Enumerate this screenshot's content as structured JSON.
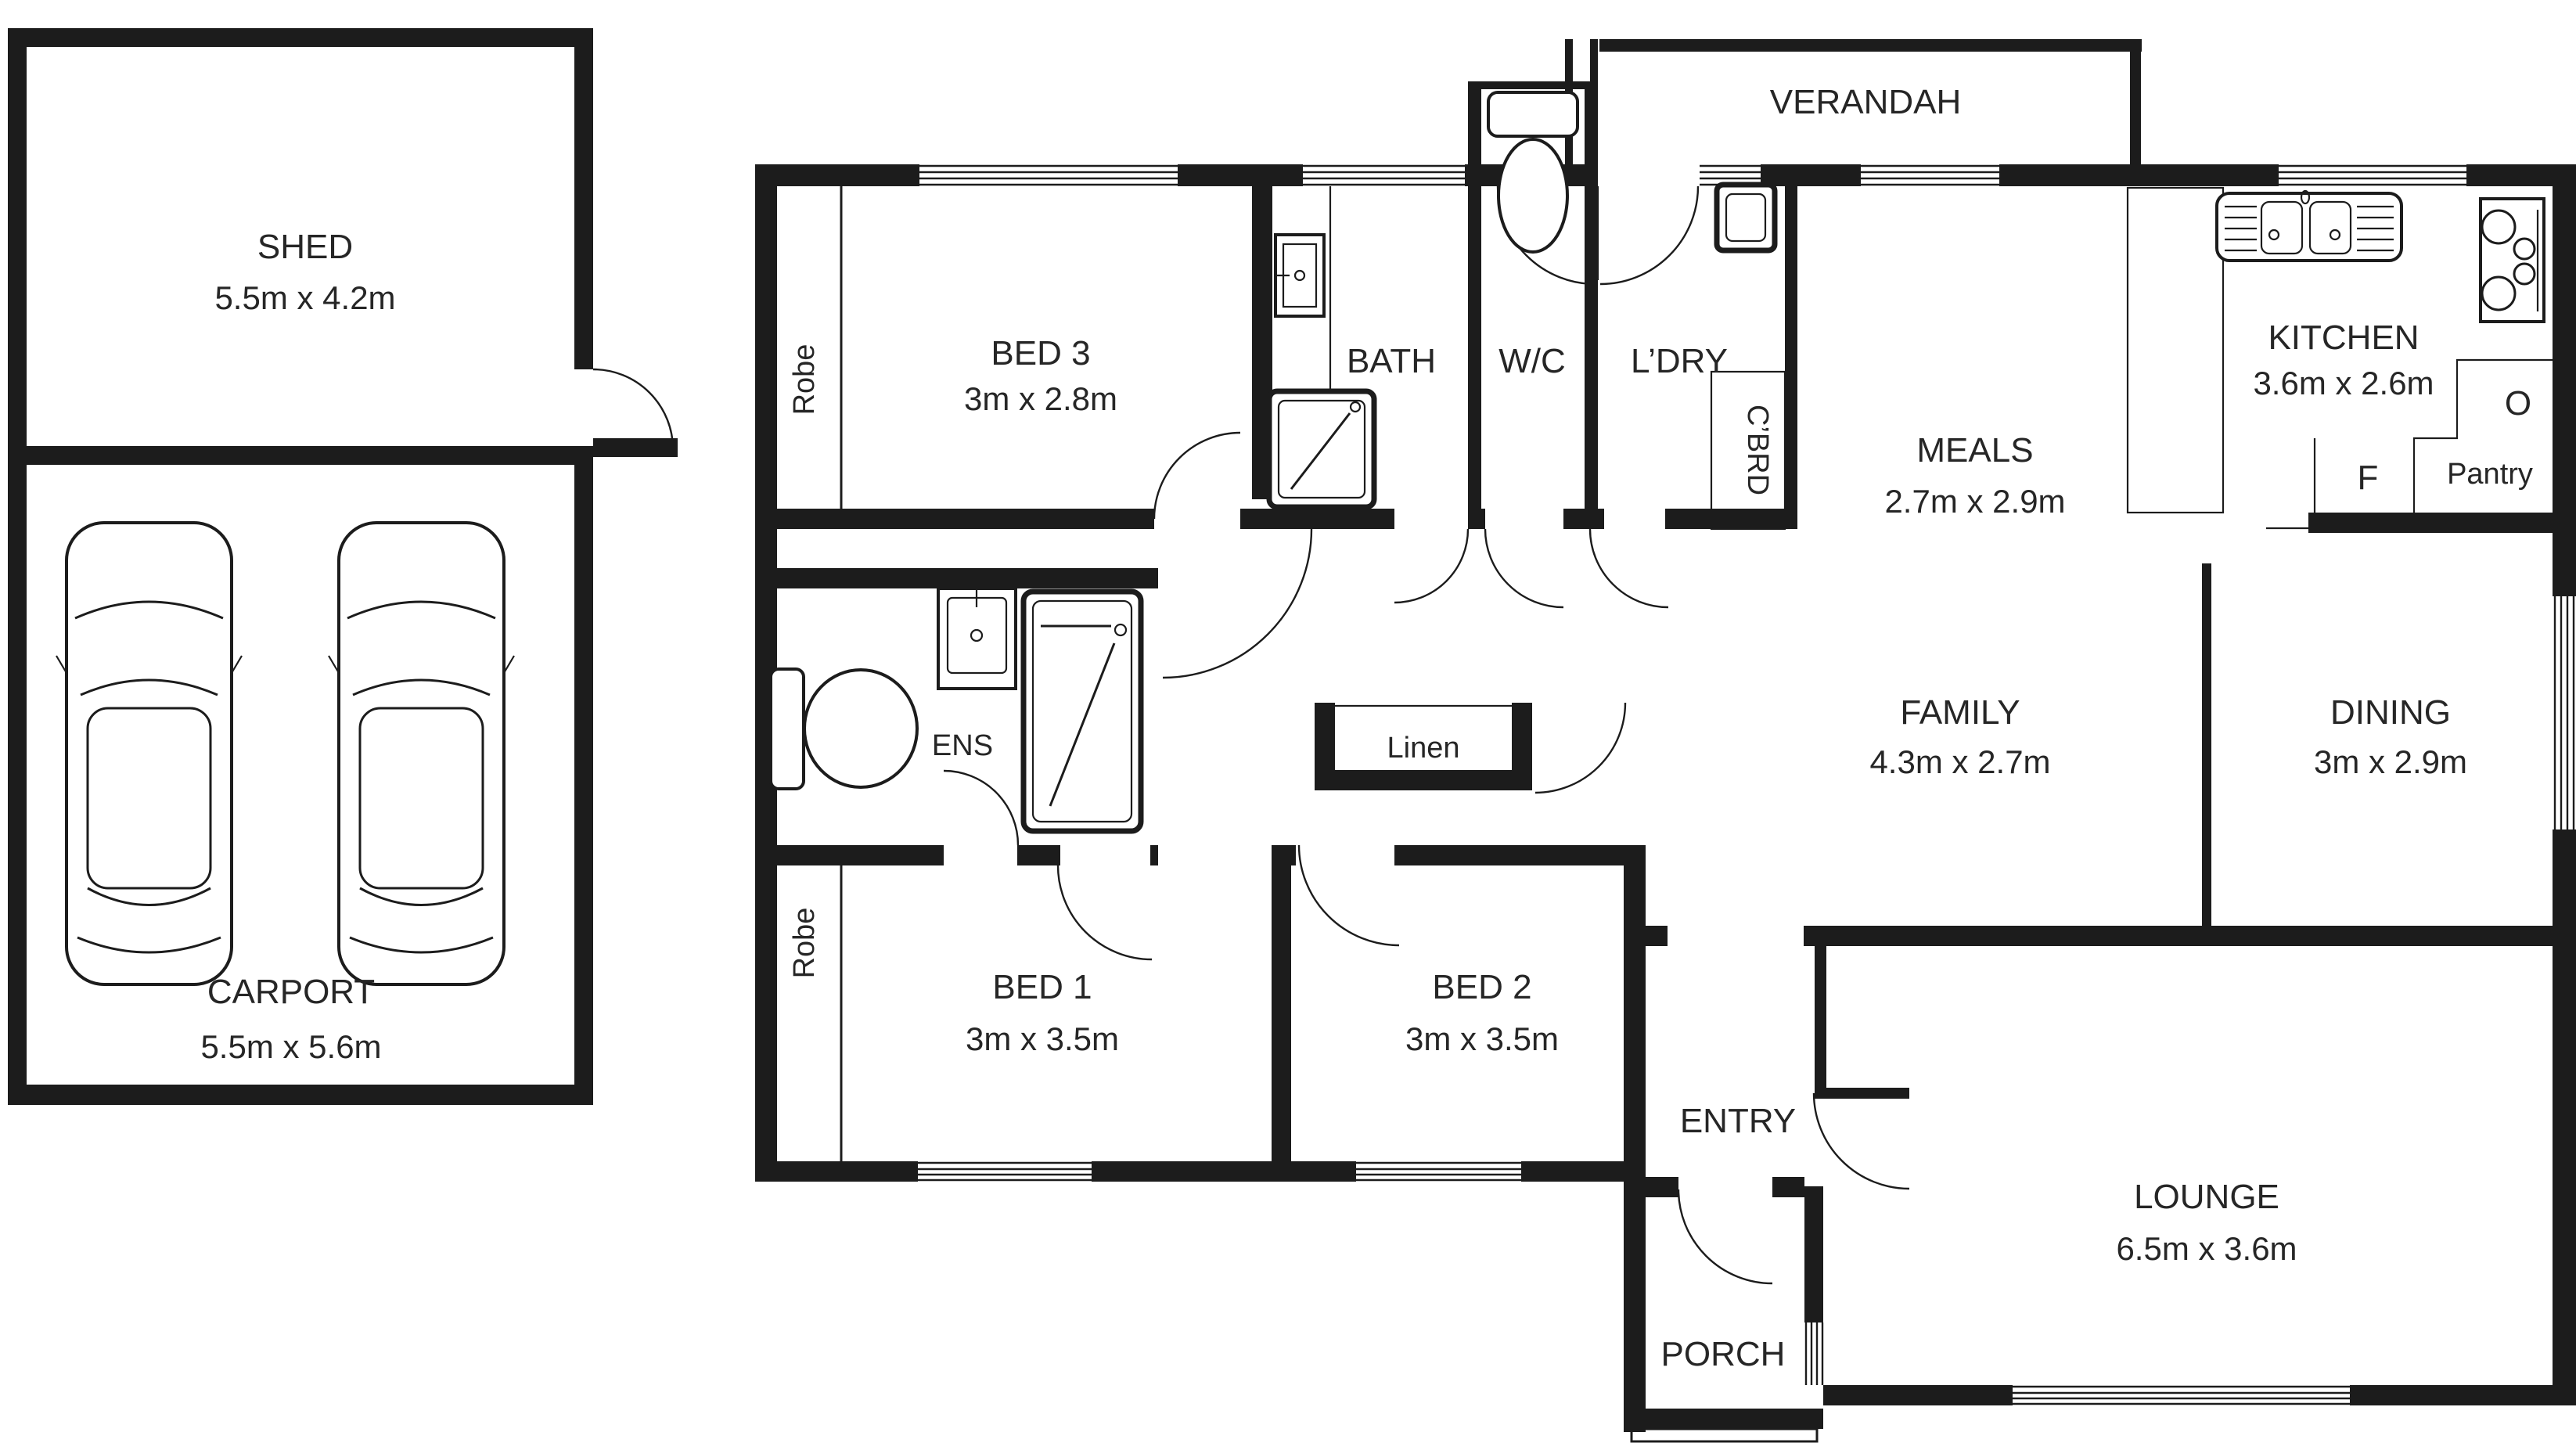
{
  "meta": {
    "title": "Floor plan",
    "line_color": "#1c1c1c",
    "background": "#ffffff"
  },
  "labels": {
    "shed": {
      "name": "SHED",
      "dims": "5.5m x 4.2m"
    },
    "carport": {
      "name": "CARPORT",
      "dims": "5.5m x 5.6m"
    },
    "bed3": {
      "name": "BED 3",
      "dims": "3m x 2.8m"
    },
    "bath": {
      "name": "BATH"
    },
    "wc": {
      "name": "W/C"
    },
    "ldry": {
      "name": "L’DRY"
    },
    "verandah": {
      "name": "VERANDAH"
    },
    "meals": {
      "name": "MEALS",
      "dims": "2.7m x 2.9m"
    },
    "kitchen": {
      "name": "KITCHEN",
      "dims": "3.6m x 2.6m"
    },
    "family": {
      "name": "FAMILY",
      "dims": "4.3m x 2.7m"
    },
    "dining": {
      "name": "DINING",
      "dims": "3m x 2.9m"
    },
    "bed1": {
      "name": "BED 1",
      "dims": "3m x 3.5m"
    },
    "bed2": {
      "name": "BED 2",
      "dims": "3m x 3.5m"
    },
    "entry": {
      "name": "ENTRY"
    },
    "lounge": {
      "name": "LOUNGE",
      "dims": "6.5m x 3.6m"
    },
    "porch": {
      "name": "PORCH"
    },
    "ens": {
      "name": "ENS"
    },
    "linen": {
      "name": "Linen"
    },
    "robe": {
      "name": "Robe"
    },
    "cbrd": {
      "name": "C’BRD"
    },
    "pantry": {
      "name": "Pantry"
    },
    "fridge": {
      "name": "F"
    },
    "oven": {
      "name": "O"
    }
  }
}
